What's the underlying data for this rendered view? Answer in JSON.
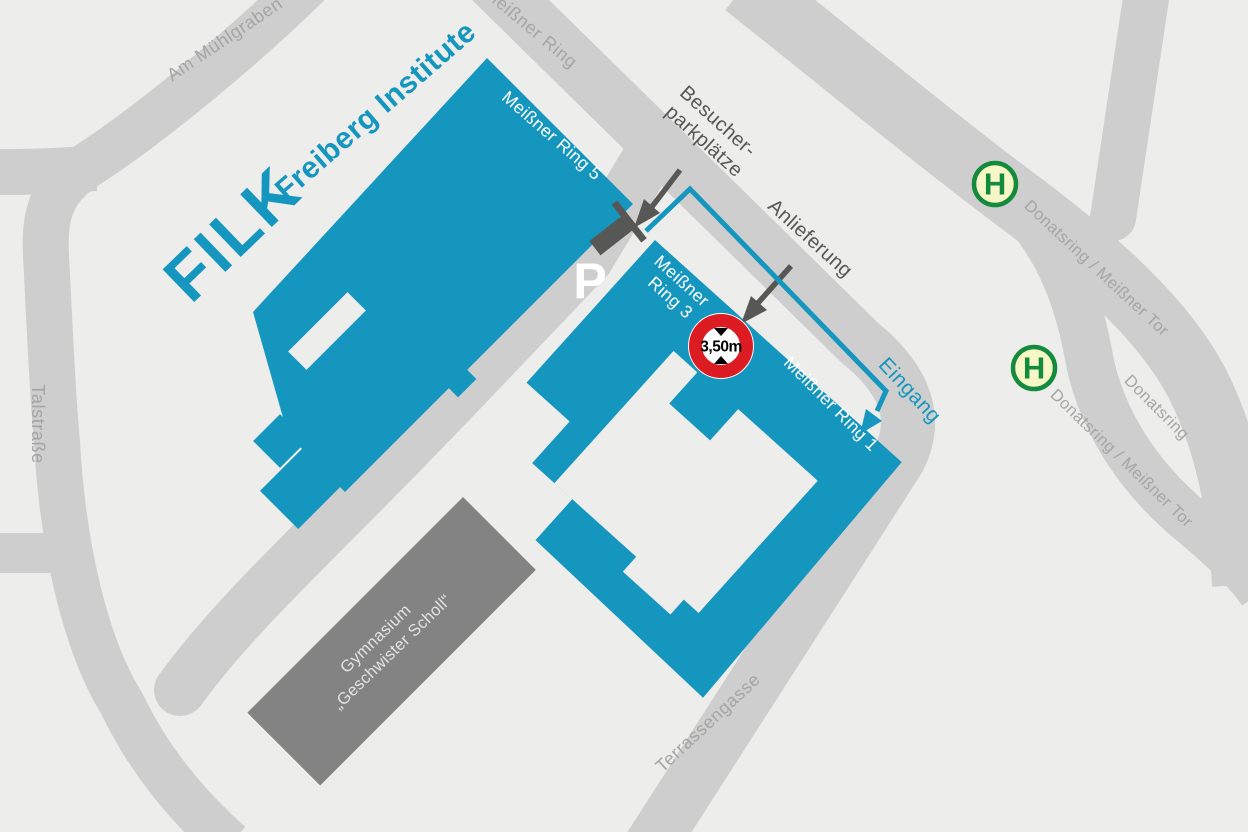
{
  "map": {
    "colors": {
      "background": "#ededec",
      "road": "#cecece",
      "building_blue": "#1596bf",
      "building_gray": "#838383",
      "street_label": "#a5a5a5",
      "dark_gray": "#575756",
      "brand_blue": "#1596bf",
      "sign_red": "#dd1b23",
      "bus_green": "#148a3c",
      "bus_fill": "#f6f6c6",
      "white": "#ffffff"
    },
    "logo": {
      "title": "FILK",
      "subtitle": "Freiberg Institute"
    },
    "streets": {
      "am_muehlgraben": "Am Mühlgraben",
      "meissner_ring": "Meißner Ring",
      "talstrasse": "Talstraße",
      "terrassengasse": "Terrassengasse",
      "donatsring_meissner_tor_upper": "Donatsring / Meißner Tor",
      "donatsring_meissner_tor_lower": "Donatsring / Meißner Tor",
      "donatsring": "Donatsring"
    },
    "buildings": {
      "meissner_ring_5": "Meißner Ring 5",
      "meissner_ring_3_line1": "Meißner",
      "meissner_ring_3_line2": "Ring 3",
      "meissner_ring_1": "Meißner Ring 1",
      "gymnasium_line1": "Gymnasium",
      "gymnasium_line2": "„Geschwister Scholl“"
    },
    "annotations": {
      "visitor_parking_line1": "Besucher-",
      "visitor_parking_line2": "parkplätze",
      "delivery": "Anlieferung",
      "entrance": "Eingang",
      "parking_symbol": "P",
      "height_limit": "3,50m",
      "bus_stop_symbol": "H"
    }
  }
}
